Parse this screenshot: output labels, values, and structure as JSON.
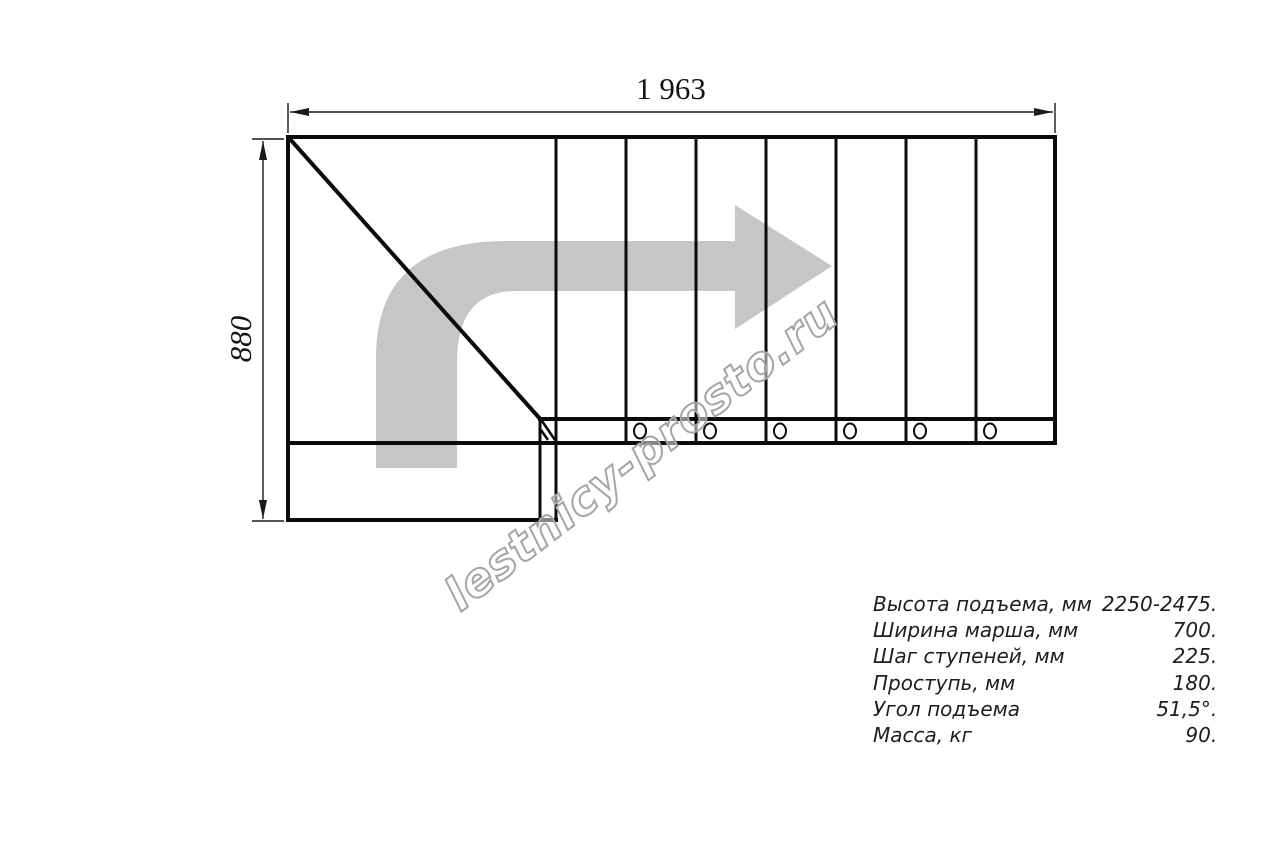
{
  "dimensions": {
    "top_width_mm": "1 963",
    "left_height_mm": "880"
  },
  "watermark": {
    "text": "lestnicy-prosto.ru"
  },
  "specs": {
    "rows": [
      {
        "label": "Высота подъема, мм",
        "value": "2250-2475."
      },
      {
        "label": "Ширина марша, мм",
        "value": "700."
      },
      {
        "label": "Шаг ступеней, мм",
        "value": "225."
      },
      {
        "label": "Проступь, мм",
        "value": "180."
      },
      {
        "label": "Угол подъема",
        "value": "51,5°."
      },
      {
        "label": "Масса, кг",
        "value": "90."
      }
    ]
  },
  "drawing": {
    "step_lines": 7,
    "bolt_count": 6,
    "arrow_color": "#c6c6c6",
    "line_color": "#0b0b0b",
    "watermark_stroke_color": "#a5a5a5"
  }
}
